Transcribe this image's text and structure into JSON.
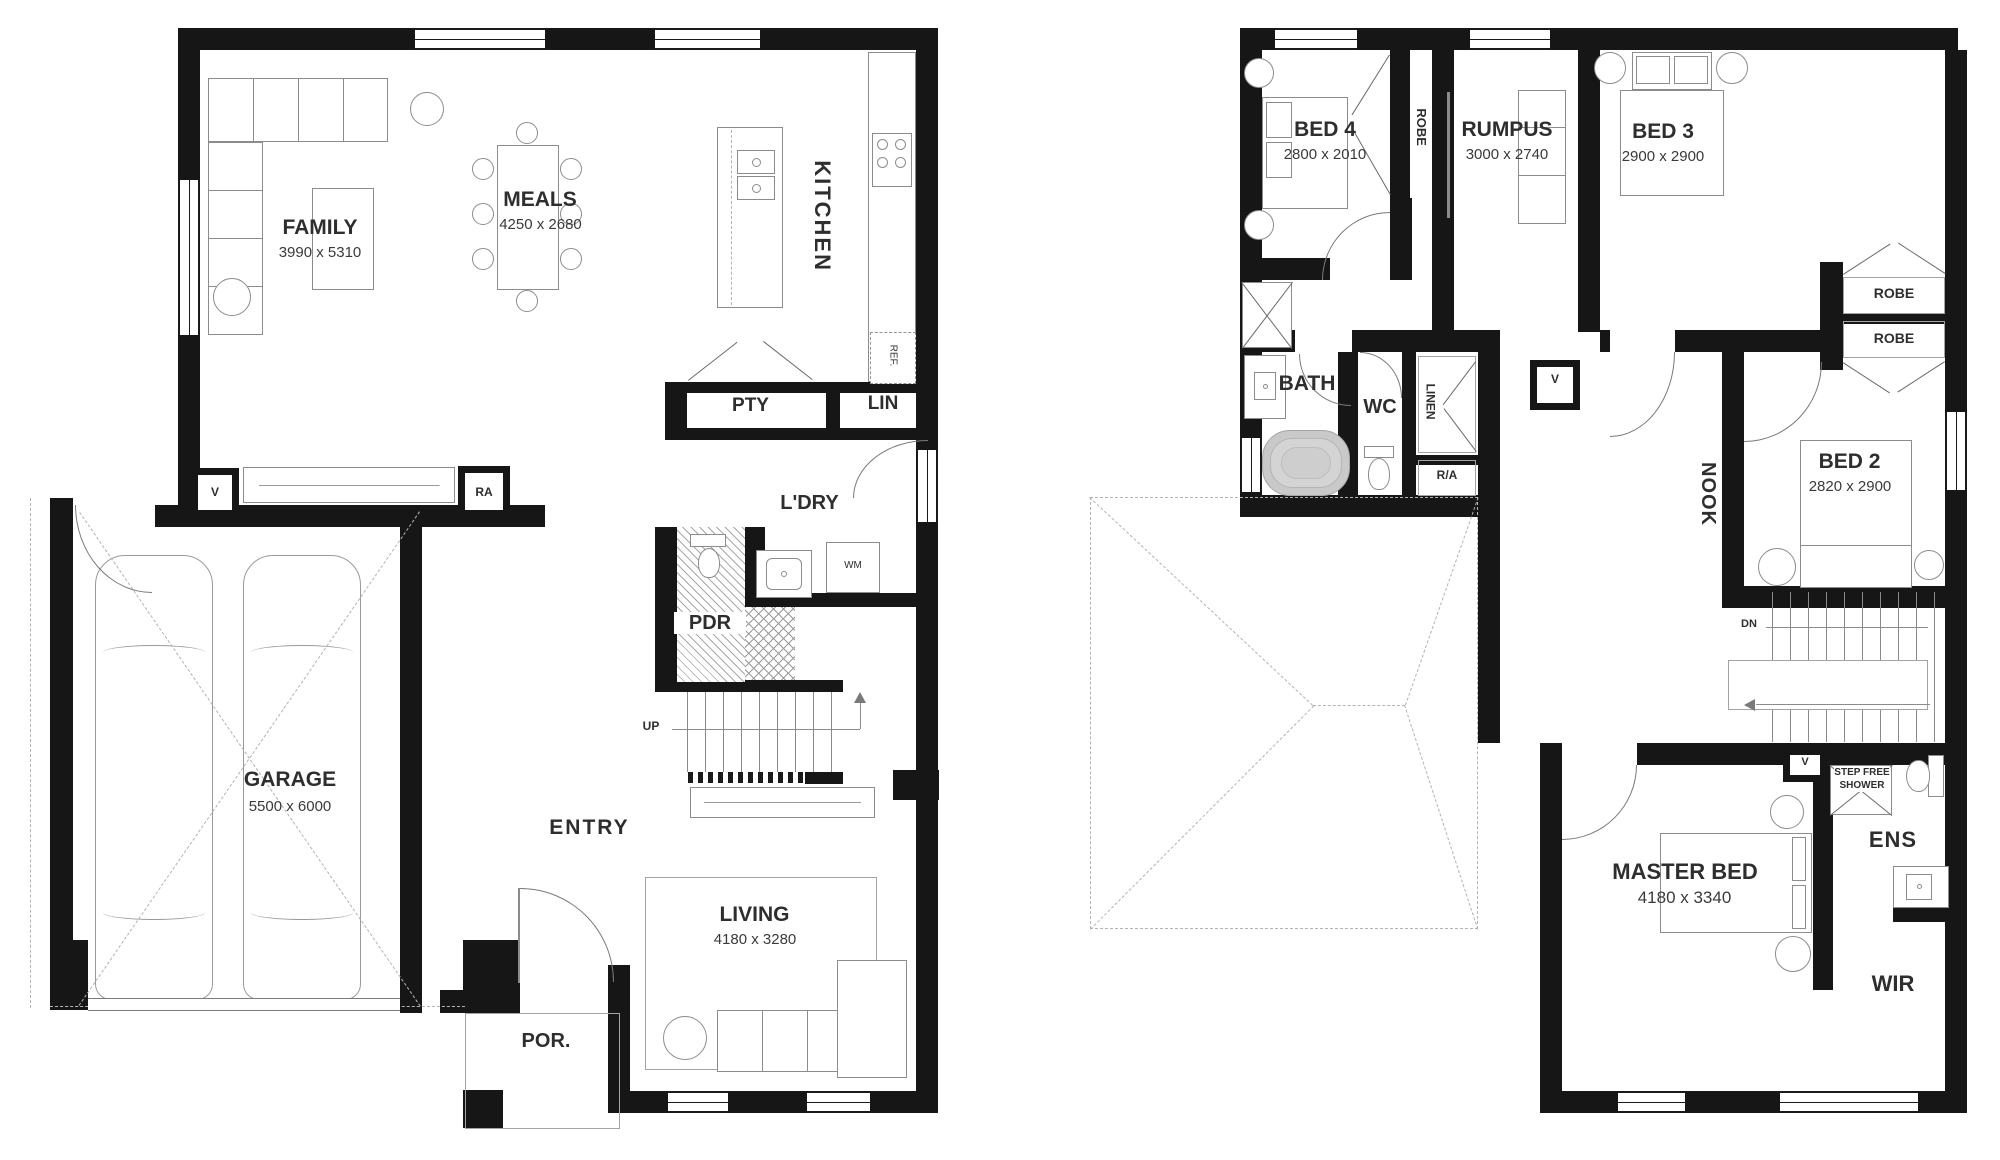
{
  "ground_floor": {
    "rooms": {
      "family": {
        "name": "FAMILY",
        "dims": "3990 x 5310"
      },
      "meals": {
        "name": "MEALS",
        "dims": "4250 x 2680"
      },
      "kitchen": {
        "name": "KITCHEN"
      },
      "pantry": {
        "name": "PTY"
      },
      "linen": {
        "name": "LIN"
      },
      "laundry": {
        "name": "L'DRY"
      },
      "powder": {
        "name": "PDR"
      },
      "garage": {
        "name": "GARAGE",
        "dims": "5500 x 6000"
      },
      "entry": {
        "name": "ENTRY"
      },
      "living": {
        "name": "LIVING",
        "dims": "4180 x 3280"
      },
      "porch": {
        "name": "POR."
      }
    },
    "markers": {
      "vent": "V",
      "return_air": "RA",
      "fridge": "REF.",
      "washing_machine": "WM",
      "stairs_up": "UP"
    }
  },
  "upper_floor": {
    "rooms": {
      "bed4": {
        "name": "BED 4",
        "dims": "2800 x 2010"
      },
      "rumpus": {
        "name": "RUMPUS",
        "dims": "3000 x 2740"
      },
      "bed3": {
        "name": "BED 3",
        "dims": "2900 x 2900"
      },
      "bed2": {
        "name": "BED 2",
        "dims": "2820 x 2900"
      },
      "master": {
        "name": "MASTER BED",
        "dims": "4180 x 3340"
      },
      "bath": {
        "name": "BATH"
      },
      "wc": {
        "name": "WC"
      },
      "nook": {
        "name": "NOOK"
      },
      "ensuite": {
        "name": "ENS"
      },
      "wardrobe": {
        "name": "WIR"
      }
    },
    "closets": {
      "robe_bed4": "ROBE",
      "robe_top": "ROBE",
      "robe_bottom": "ROBE",
      "linen": "LINEN"
    },
    "markers": {
      "return_air": "R/A",
      "vent_hall": "V",
      "vent_master": "V",
      "stairs_down": "DN",
      "step_free_shower": "STEP FREE SHOWER"
    }
  }
}
